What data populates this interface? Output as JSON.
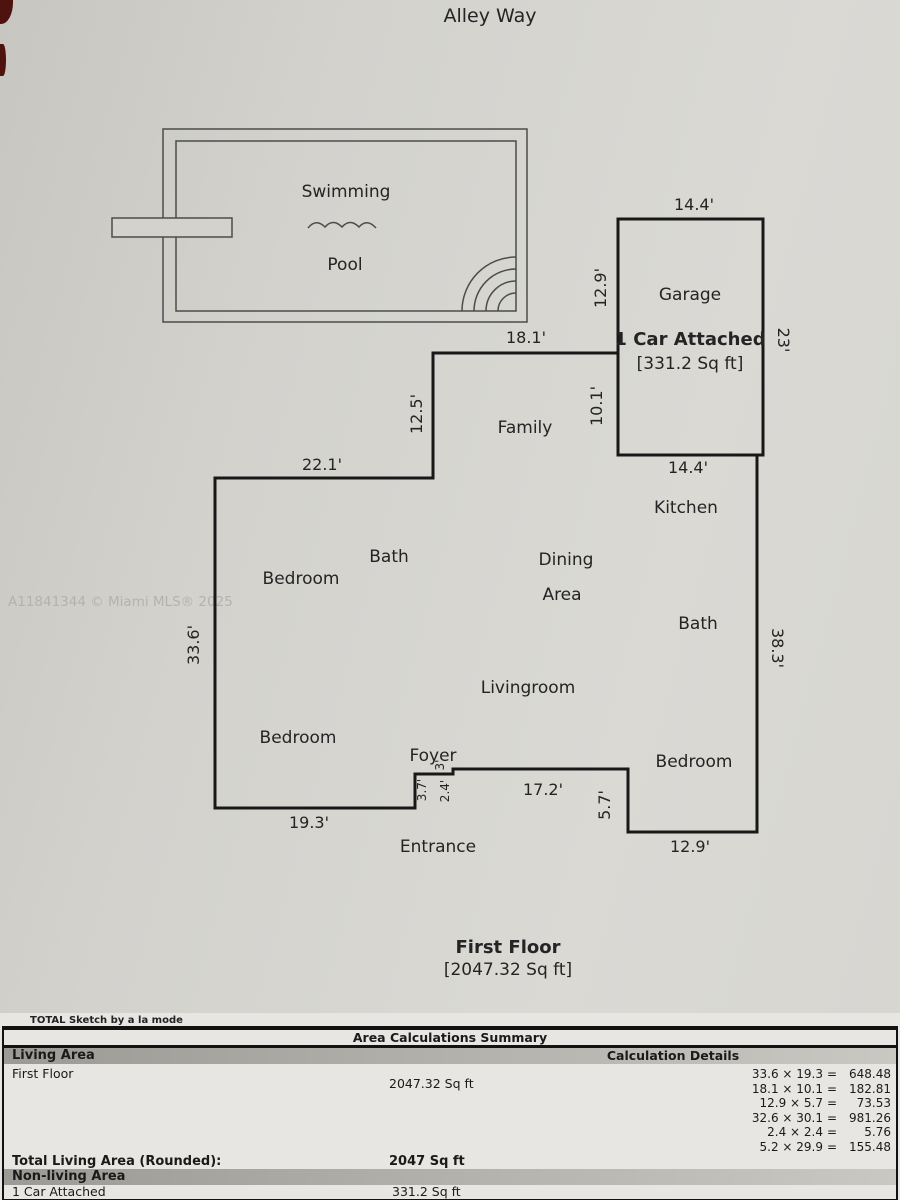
{
  "header": {
    "street": "Alley Way"
  },
  "watermark": "A11841344 © Miami MLS® 2025",
  "pool": {
    "line1": "Swimming",
    "line2": "Pool"
  },
  "garage": {
    "name": "Garage",
    "type": "1 Car Attached",
    "area": "[331.2 Sq ft]",
    "dim_top": "14.4'",
    "dim_bottom": "14.4'",
    "dim_right": "23'",
    "dim_left_upper": "12.9'",
    "dim_left_lower": "10.1'"
  },
  "rooms": {
    "family": "Family",
    "kitchen": "Kitchen",
    "bath_left": "Bath",
    "bedroom_top_left": "Bedroom",
    "dining_line1": "Dining",
    "dining_line2": "Area",
    "bath_right": "Bath",
    "livingroom": "Livingroom",
    "bedroom_bottom_left": "Bedroom",
    "foyer": "Foyer",
    "bedroom_right": "Bedroom",
    "entrance": "Entrance"
  },
  "dimensions": {
    "family_top": "18.1'",
    "family_left": "12.5'",
    "wing_top": "22.1'",
    "west": "33.6'",
    "south_left": "19.3'",
    "foyer_top": "3'",
    "foyer_left": "3.7'",
    "foyer_right": "2.4'",
    "south_mid": "17.2'",
    "entry_step": "5.7'",
    "south_right": "12.9'",
    "east": "38.3'"
  },
  "floor": {
    "title": "First Floor",
    "area": "[2047.32 Sq ft]"
  },
  "summary": {
    "brand": "TOTAL Sketch by a la mode",
    "title": "Area Calculations Summary",
    "living_header": "Living Area",
    "calc_header": "Calculation Details",
    "first_floor_label": "First Floor",
    "first_floor_area": "2047.32 Sq ft",
    "calculations": [
      {
        "expr": "33.6 × 19.3",
        "eq": "=",
        "result": "648.48"
      },
      {
        "expr": "18.1 × 10.1",
        "eq": "=",
        "result": "182.81"
      },
      {
        "expr": "12.9 × 5.7",
        "eq": "=",
        "result": "73.53"
      },
      {
        "expr": "32.6 × 30.1",
        "eq": "=",
        "result": "981.26"
      },
      {
        "expr": "2.4 × 2.4",
        "eq": "=",
        "result": "5.76"
      },
      {
        "expr": "5.2 × 29.9",
        "eq": "=",
        "result": "155.48"
      }
    ],
    "total_label": "Total Living Area (Rounded):",
    "total_value": "2047 Sq ft",
    "nonliving_header": "Non-living Area",
    "nonliving_label": "1 Car Attached",
    "nonliving_value": "331.2 Sq ft"
  }
}
